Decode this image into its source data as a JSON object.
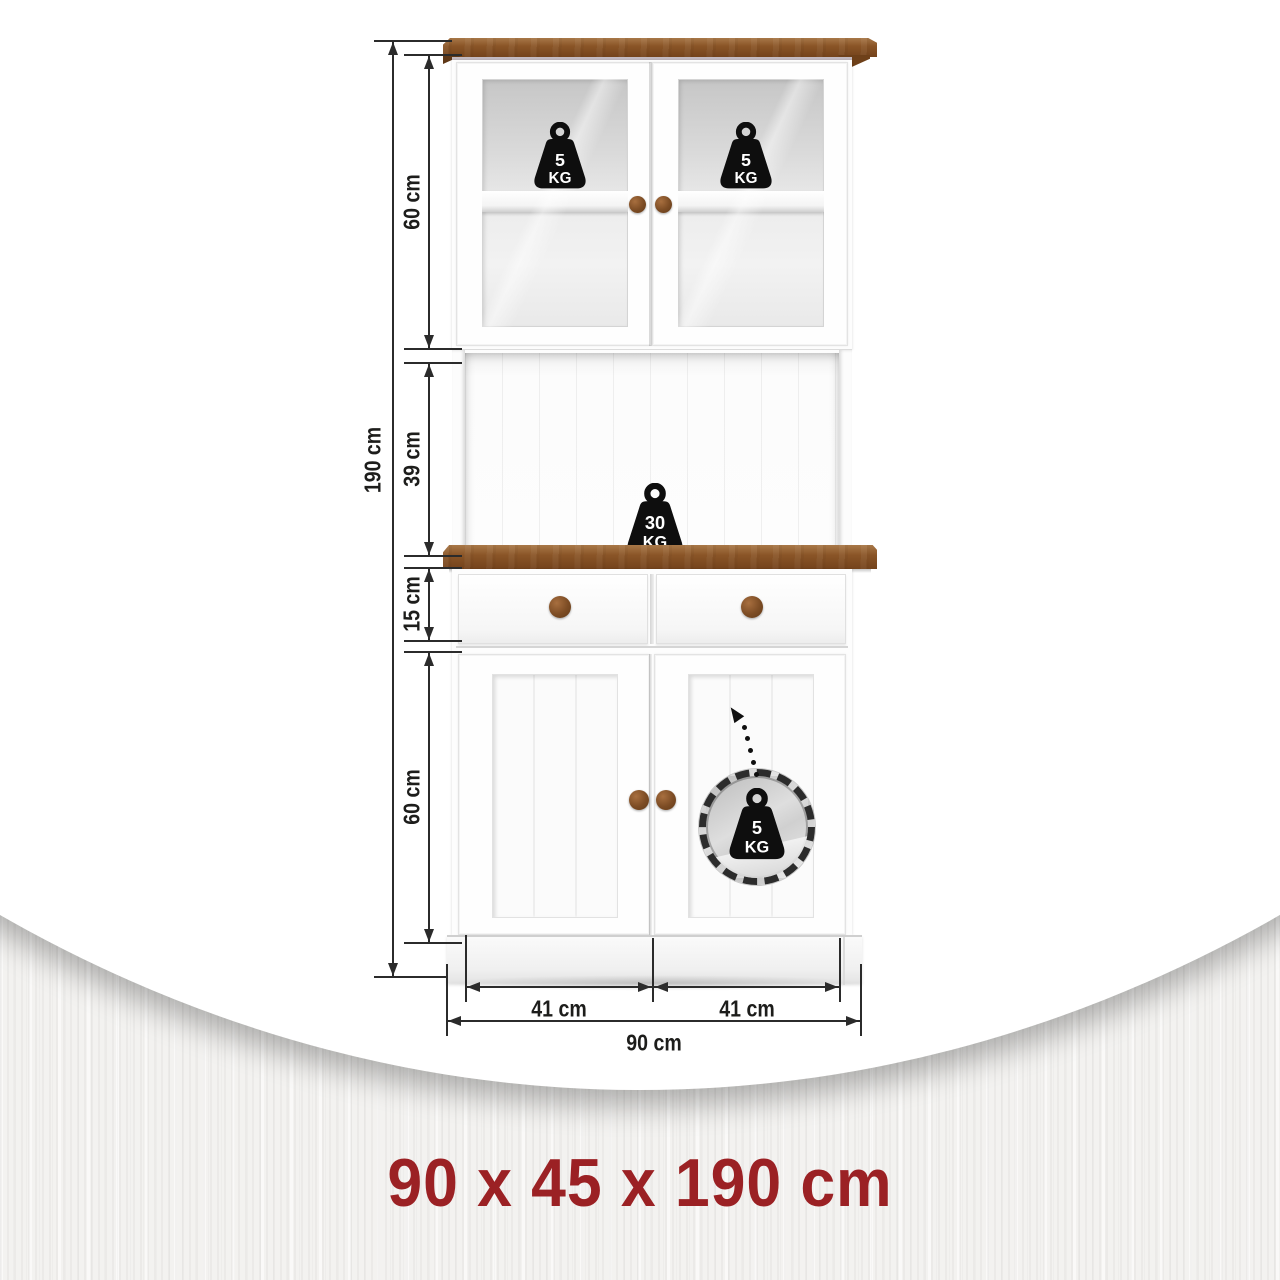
{
  "theme": {
    "accent": "#9b2124",
    "wood": "#8a5527",
    "wood_dark": "#74431c",
    "wood_light": "#a87848",
    "line": "#2b2b2b"
  },
  "summary": {
    "text": "90 x 45 x 190 cm"
  },
  "measurements": {
    "total_height": "190 cm",
    "upper_section_height": "60 cm",
    "open_shelf_height": "39 cm",
    "drawer_height": "15 cm",
    "lower_section_height": "60 cm",
    "left_door_width": "41 cm",
    "right_door_width": "41 cm",
    "total_width": "90 cm"
  },
  "load_capacities": {
    "upper_left_shelf": {
      "value": "5",
      "unit": "KG"
    },
    "upper_right_shelf": {
      "value": "5",
      "unit": "KG"
    },
    "countertop": {
      "value": "30",
      "unit": "KG"
    },
    "lower_inner_shelf": {
      "value": "5",
      "unit": "KG"
    }
  }
}
